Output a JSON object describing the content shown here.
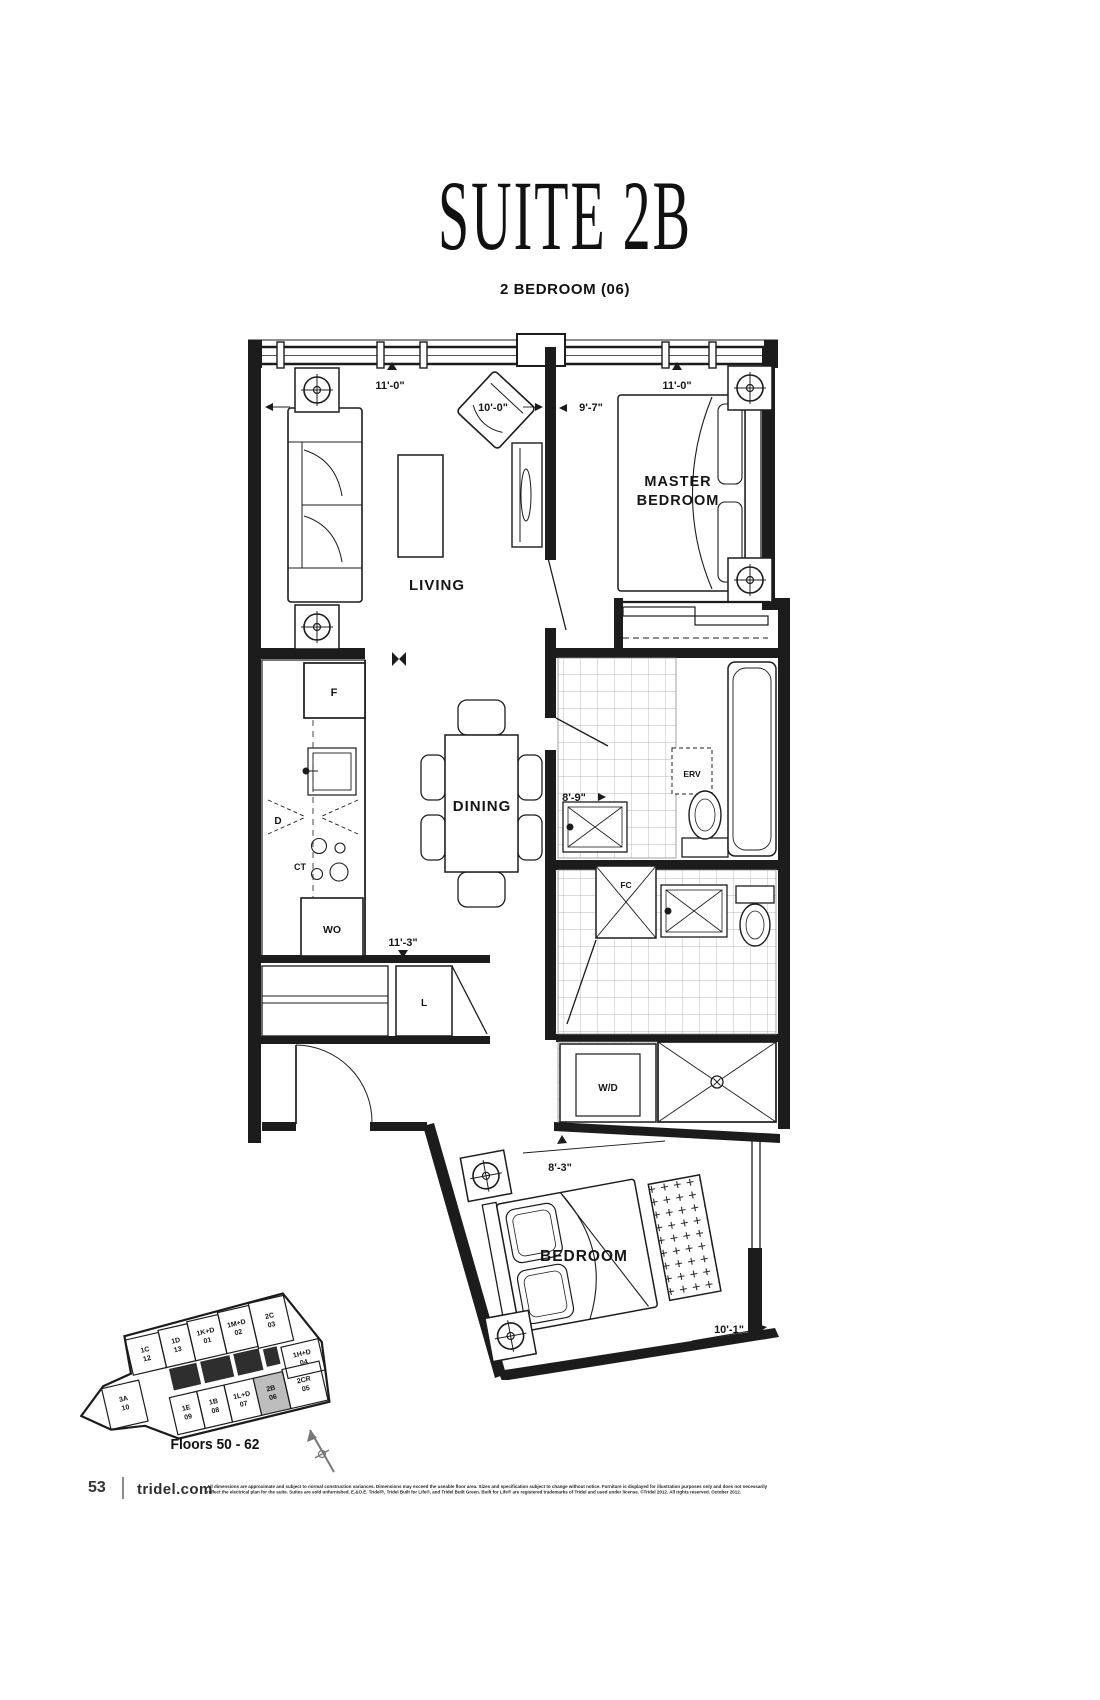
{
  "page": {
    "title": "SUITE 2B",
    "subtitle": "2 BEDROOM (06)",
    "floors_label": "Floors 50 - 62",
    "page_number": "53",
    "website": "tridel.com",
    "disclaimer_line1": "All dimensions are approximate and subject to normal construction variances. Dimensions may exceed the useable floor area. Sizes and specification subject to change without notice. Furniture is displayed for illustration purposes only and does not necessarily",
    "disclaimer_line2": "reflect the electrical plan for the suite. Suites are sold unfurnished. E.&O.E. Tridel®, Tridel Built for Life®, and Tridel Built Green. Built for Life® are registered trademarks of Tridel and used under license. ©Tridel 2012. All rights reserved. October 2012."
  },
  "floorplan": {
    "rooms": {
      "living": "LIVING",
      "master_line1": "MASTER",
      "master_line2": "BEDROOM",
      "dining": "DINING",
      "bedroom": "BEDROOM"
    },
    "dimensions": {
      "living_window": "11'-0\"",
      "living_width": "10'-0\"",
      "master_entry": "9'-7\"",
      "master_window": "11'-0\"",
      "hall": "8'-9\"",
      "kitchen": "11'-3\"",
      "bedroom_width": "8'-3\"",
      "bedroom_window": "10'-1\""
    },
    "appliances": {
      "fridge": "F",
      "dishwasher": "D",
      "cooktop": "CT",
      "wall_oven": "WO",
      "linen_closet": "L",
      "erv": "ERV",
      "fan_coil": "FC",
      "washer_dryer": "W/D"
    }
  },
  "keyplan": {
    "highlighted_unit": "2B 06",
    "units": [
      {
        "code": "1C",
        "num": "12"
      },
      {
        "code": "1D",
        "num": "13"
      },
      {
        "code": "1K+D",
        "num": "01"
      },
      {
        "code": "1M+D",
        "num": "02"
      },
      {
        "code": "2C",
        "num": "03"
      },
      {
        "code": "1H+D",
        "num": "04"
      },
      {
        "code": "3A",
        "num": "10"
      },
      {
        "code": "1E",
        "num": "09"
      },
      {
        "code": "1B",
        "num": "08"
      },
      {
        "code": "1L+D",
        "num": "07"
      },
      {
        "code": "2B",
        "num": "06"
      },
      {
        "code": "2CR",
        "num": "05"
      }
    ]
  }
}
